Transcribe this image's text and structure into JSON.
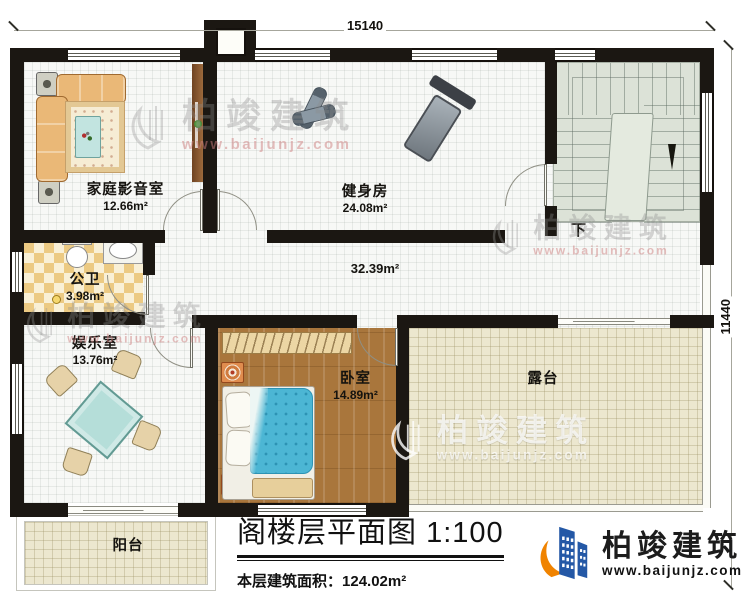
{
  "dimensions": {
    "top": "15140",
    "right": "11440"
  },
  "rooms": [
    {
      "name": "家庭影音室",
      "area": "12.66m²"
    },
    {
      "name": "健身房",
      "area": "24.08m²"
    },
    {
      "name": "公卫",
      "area": "3.98m²"
    },
    {
      "name": "娱乐室",
      "area": "13.76m²"
    },
    {
      "name": "卧室",
      "area": "14.89m²"
    },
    {
      "name": "露台",
      "area": ""
    },
    {
      "name": "阳台",
      "area": ""
    },
    {
      "name": "",
      "area": "32.39m²"
    }
  ],
  "stairs": {
    "down_label": "下"
  },
  "title_block": {
    "title": "阁楼层平面图",
    "scale": "1:100",
    "area_label": "本层建筑面积：",
    "area_value": "124.02m²"
  },
  "branding": {
    "logo_name": "柏竣建筑",
    "logo_url": "www.baijunjz.com"
  },
  "watermark": {
    "name": "柏竣建筑",
    "url": "www.baijunjz.com"
  },
  "colors": {
    "wall": "#1b1712",
    "wood_floor": "#a9763c",
    "terrace_floor": "#ece7cf",
    "stair_floor": "#dce2d7",
    "bathroom_tile": "#ecca83",
    "bed_quilt": "#4cb6d4",
    "logo_blue": "#2458a6",
    "logo_orange": "#f08300"
  }
}
